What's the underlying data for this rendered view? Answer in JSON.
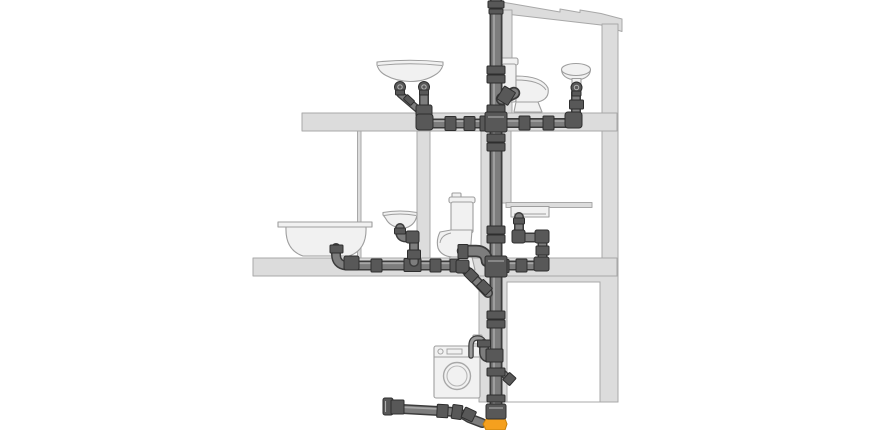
{
  "diagram": {
    "type": "illustration",
    "subject": "house-drainage-system-cross-section",
    "floors_shown": 3,
    "text_labels": []
  },
  "colors": {
    "background": "#ffffff",
    "wall_fill": "#dcdcdc",
    "wall_line": "#a8a8a8",
    "fixture_fill": "#f1f1f1",
    "fixture_line": "#9e9e9e",
    "pipe_body": "#7d7d7d",
    "pipe_outline": "#3c3c3c",
    "pipe_highlight": "#aeaeae",
    "fitting_fill": "#585858",
    "fitting_line": "#2e2e2e",
    "sewer_orange": "#f5a01e",
    "sewer_orange_line": "#c67f0a"
  },
  "components": [
    {
      "name": "roof",
      "desc": "sloped roof beam, upper right"
    },
    {
      "name": "right-exterior-wall",
      "desc": "full-height wall on the right"
    },
    {
      "name": "floor-slab-top",
      "desc": "upper floor slab"
    },
    {
      "name": "floor-slab-middle",
      "desc": "lower floor slab"
    },
    {
      "name": "soil-stack",
      "desc": "vertical soil and vent stack from roof to sewer"
    },
    {
      "name": "top-washbasin",
      "desc": "attic double-trap washbasin, left"
    },
    {
      "name": "top-toilet",
      "desc": "attic toilet beside stack"
    },
    {
      "name": "top-corner-sink",
      "desc": "small round pedestal sink, attic right"
    },
    {
      "name": "bathtub",
      "desc": "bathtub, middle floor left"
    },
    {
      "name": "middle-washbasin",
      "desc": "wall-hung washbasin, middle floor"
    },
    {
      "name": "middle-toilet",
      "desc": "toilet, middle floor"
    },
    {
      "name": "kitchen-sink",
      "desc": "kitchen counter sink right of stack"
    },
    {
      "name": "washing-machine",
      "desc": "washing machine on ground floor with standpipe hose"
    },
    {
      "name": "branch-pipes",
      "desc": "horizontal waste branches on both floors"
    },
    {
      "name": "cleanout-cap",
      "desc": "capped access fitting at bottom left branch"
    },
    {
      "name": "sewer-socket",
      "desc": "orange underground sewer socket at stack base"
    }
  ]
}
